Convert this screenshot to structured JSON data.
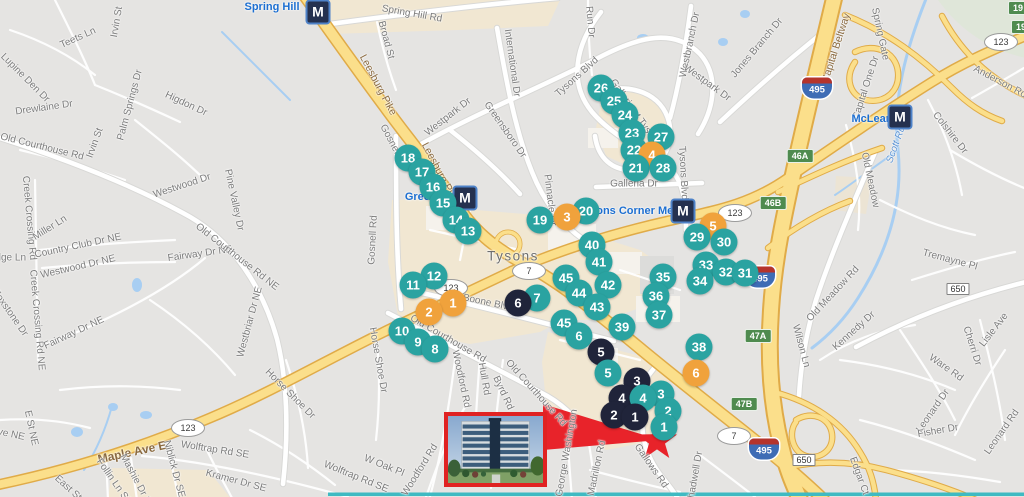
{
  "colors": {
    "teal": "#2aa3a1",
    "orange": "#f0a23c",
    "black": "#20243a",
    "red": "#e8232a",
    "metro_label": "#1d6fd1",
    "road_label": "#7b7b7b",
    "hwy_label": "#8a6a40",
    "water_label": "#5d94d4",
    "city_label": "#6e6e6e"
  },
  "map": {
    "metro_m": "M",
    "star": {
      "x": 657,
      "y": 441
    },
    "inset": {
      "x": 444,
      "y": 412,
      "w": 95,
      "h": 67
    },
    "metro_stations": [
      {
        "name": "Spring Hill",
        "mx": 318,
        "my": 12,
        "lx": 272,
        "ly": 7
      },
      {
        "name": "Greensboro",
        "mx": 465,
        "my": 198,
        "lx": 436,
        "ly": 197
      },
      {
        "name": "Tysons Corner Metro",
        "mx": 683,
        "my": 211,
        "lx": 633,
        "ly": 211
      },
      {
        "name": "McLean",
        "mx": 900,
        "my": 117,
        "lx": 872,
        "ly": 119
      }
    ],
    "shields": [
      {
        "type": "oval",
        "n": "123",
        "x": 188,
        "y": 428
      },
      {
        "type": "oval",
        "n": "123",
        "x": 451,
        "y": 288
      },
      {
        "type": "oval",
        "n": "123",
        "x": 735,
        "y": 213
      },
      {
        "type": "oval",
        "n": "123",
        "x": 1001,
        "y": 42
      },
      {
        "type": "oval",
        "n": "7",
        "x": 529,
        "y": 271
      },
      {
        "type": "oval",
        "n": "7",
        "x": 734,
        "y": 436
      },
      {
        "type": "i495",
        "n": "495",
        "x": 817,
        "y": 88
      },
      {
        "type": "i495",
        "n": "495",
        "x": 760,
        "y": 277
      },
      {
        "type": "i495",
        "n": "495",
        "x": 764,
        "y": 449
      },
      {
        "type": "green",
        "n": "46A",
        "x": 800,
        "y": 156
      },
      {
        "type": "green",
        "n": "46B",
        "x": 773,
        "y": 203
      },
      {
        "type": "green",
        "n": "47A",
        "x": 758,
        "y": 336
      },
      {
        "type": "green",
        "n": "47B",
        "x": 744,
        "y": 404
      },
      {
        "type": "green",
        "n": "19",
        "x": 1018,
        "y": 8
      },
      {
        "type": "green",
        "n": "19",
        "x": 1021,
        "y": 27
      },
      {
        "type": "rect",
        "n": "650",
        "x": 958,
        "y": 289
      },
      {
        "type": "rect",
        "n": "650",
        "x": 804,
        "y": 460
      }
    ],
    "markers": [
      {
        "n": "26",
        "c": "teal",
        "x": 601,
        "y": 88
      },
      {
        "n": "25",
        "c": "teal",
        "x": 614,
        "y": 101
      },
      {
        "n": "24",
        "c": "teal",
        "x": 625,
        "y": 115
      },
      {
        "n": "23",
        "c": "teal",
        "x": 632,
        "y": 133
      },
      {
        "n": "27",
        "c": "teal",
        "x": 661,
        "y": 137
      },
      {
        "n": "22",
        "c": "teal",
        "x": 634,
        "y": 150
      },
      {
        "n": "4",
        "c": "orange",
        "x": 652,
        "y": 155
      },
      {
        "n": "18",
        "c": "teal",
        "x": 408,
        "y": 158
      },
      {
        "n": "21",
        "c": "teal",
        "x": 636,
        "y": 168
      },
      {
        "n": "28",
        "c": "teal",
        "x": 663,
        "y": 168
      },
      {
        "n": "17",
        "c": "teal",
        "x": 422,
        "y": 172
      },
      {
        "n": "16",
        "c": "teal",
        "x": 433,
        "y": 187
      },
      {
        "n": "15",
        "c": "teal",
        "x": 443,
        "y": 203
      },
      {
        "n": "20",
        "c": "teal",
        "x": 586,
        "y": 211
      },
      {
        "n": "3",
        "c": "orange",
        "x": 567,
        "y": 217
      },
      {
        "n": "19",
        "c": "teal",
        "x": 540,
        "y": 220
      },
      {
        "n": "14",
        "c": "teal",
        "x": 456,
        "y": 220
      },
      {
        "n": "5",
        "c": "orange",
        "x": 713,
        "y": 226
      },
      {
        "n": "13",
        "c": "teal",
        "x": 468,
        "y": 231
      },
      {
        "n": "29",
        "c": "teal",
        "x": 697,
        "y": 237
      },
      {
        "n": "30",
        "c": "teal",
        "x": 724,
        "y": 242
      },
      {
        "n": "40",
        "c": "teal",
        "x": 592,
        "y": 245
      },
      {
        "n": "41",
        "c": "teal",
        "x": 599,
        "y": 262
      },
      {
        "n": "33",
        "c": "teal",
        "x": 706,
        "y": 265
      },
      {
        "n": "32",
        "c": "teal",
        "x": 726,
        "y": 272
      },
      {
        "n": "31",
        "c": "teal",
        "x": 745,
        "y": 273
      },
      {
        "n": "12",
        "c": "teal",
        "x": 434,
        "y": 276
      },
      {
        "n": "35",
        "c": "teal",
        "x": 663,
        "y": 277
      },
      {
        "n": "45",
        "c": "teal",
        "x": 566,
        "y": 278
      },
      {
        "n": "34",
        "c": "teal",
        "x": 700,
        "y": 281
      },
      {
        "n": "42",
        "c": "teal",
        "x": 608,
        "y": 285
      },
      {
        "n": "11",
        "c": "teal",
        "x": 413,
        "y": 285
      },
      {
        "n": "44",
        "c": "teal",
        "x": 579,
        "y": 293
      },
      {
        "n": "36",
        "c": "teal",
        "x": 656,
        "y": 296
      },
      {
        "n": "7",
        "c": "teal",
        "x": 537,
        "y": 298
      },
      {
        "n": "6",
        "c": "black",
        "x": 518,
        "y": 303
      },
      {
        "n": "1",
        "c": "orange",
        "x": 453,
        "y": 303
      },
      {
        "n": "43",
        "c": "teal",
        "x": 597,
        "y": 307
      },
      {
        "n": "2",
        "c": "orange",
        "x": 429,
        "y": 312
      },
      {
        "n": "37",
        "c": "teal",
        "x": 659,
        "y": 315
      },
      {
        "n": "45",
        "c": "teal",
        "x": 564,
        "y": 323
      },
      {
        "n": "39",
        "c": "teal",
        "x": 622,
        "y": 327
      },
      {
        "n": "10",
        "c": "teal",
        "x": 402,
        "y": 331
      },
      {
        "n": "6",
        "c": "teal",
        "x": 579,
        "y": 336
      },
      {
        "n": "9",
        "c": "teal",
        "x": 418,
        "y": 342
      },
      {
        "n": "38",
        "c": "teal",
        "x": 699,
        "y": 347
      },
      {
        "n": "8",
        "c": "teal",
        "x": 435,
        "y": 349
      },
      {
        "n": "5",
        "c": "black",
        "x": 601,
        "y": 352
      },
      {
        "n": "5",
        "c": "teal",
        "x": 608,
        "y": 373
      },
      {
        "n": "6",
        "c": "orange",
        "x": 696,
        "y": 373
      },
      {
        "n": "3",
        "c": "black",
        "x": 637,
        "y": 381
      },
      {
        "n": "3",
        "c": "teal",
        "x": 661,
        "y": 394
      },
      {
        "n": "4",
        "c": "black",
        "x": 622,
        "y": 398
      },
      {
        "n": "4",
        "c": "teal",
        "x": 643,
        "y": 398
      },
      {
        "n": "2",
        "c": "teal",
        "x": 668,
        "y": 411
      },
      {
        "n": "2",
        "c": "black",
        "x": 614,
        "y": 415
      },
      {
        "n": "1",
        "c": "black",
        "x": 635,
        "y": 417
      },
      {
        "n": "1",
        "c": "teal",
        "x": 664,
        "y": 427
      }
    ],
    "road_labels": [
      {
        "t": "Spring Hill Rd",
        "x": 412,
        "y": 14,
        "r": 10
      },
      {
        "t": "Broad St",
        "x": 386,
        "y": 40,
        "r": 75
      },
      {
        "t": "Leesburg Pike",
        "x": 378,
        "y": 85,
        "r": 62,
        "cls": "hwy"
      },
      {
        "t": "Leesburg Pike",
        "x": 440,
        "y": 173,
        "r": 62,
        "cls": "hwy"
      },
      {
        "t": "International Dr",
        "x": 512,
        "y": 63,
        "r": 82
      },
      {
        "t": "Westpark Dr",
        "x": 448,
        "y": 117,
        "r": -38
      },
      {
        "t": "Greensboro Dr",
        "x": 505,
        "y": 130,
        "r": 55
      },
      {
        "t": "Gosnell Rd",
        "x": 394,
        "y": 147,
        "r": 62
      },
      {
        "t": "Gosnell Rd",
        "x": 373,
        "y": 240,
        "r": -87
      },
      {
        "t": "Teets Ln",
        "x": 78,
        "y": 38,
        "r": -24
      },
      {
        "t": "Irvin St",
        "x": 117,
        "y": 22,
        "r": -80
      },
      {
        "t": "Irvin St",
        "x": 95,
        "y": 143,
        "r": -70
      },
      {
        "t": "Lupine Den Dr",
        "x": 25,
        "y": 78,
        "r": 45
      },
      {
        "t": "Drewlaine Dr",
        "x": 44,
        "y": 108,
        "r": -8
      },
      {
        "t": "Palm Springs Dr",
        "x": 130,
        "y": 105,
        "r": -75
      },
      {
        "t": "Higdon Dr",
        "x": 186,
        "y": 104,
        "r": 25
      },
      {
        "t": "Old Courthouse Rd",
        "x": 42,
        "y": 147,
        "r": 14
      },
      {
        "t": "Creek Crossing Rd",
        "x": 29,
        "y": 218,
        "r": 85
      },
      {
        "t": "Miller Ln",
        "x": 50,
        "y": 228,
        "r": -32
      },
      {
        "t": "Country Club Dr NE",
        "x": 78,
        "y": 246,
        "r": -12
      },
      {
        "t": "Westwood Dr NE",
        "x": 78,
        "y": 267,
        "r": -13
      },
      {
        "t": "Ridge Ln",
        "x": 6,
        "y": 258,
        "r": 0
      },
      {
        "t": "Creek Crossing Rd NE",
        "x": 37,
        "y": 320,
        "r": 85
      },
      {
        "t": "Foxstone Dr",
        "x": 10,
        "y": 313,
        "r": 55
      },
      {
        "t": "Fairway Dr NE",
        "x": 74,
        "y": 333,
        "r": -25
      },
      {
        "t": "Fairway Dr NE",
        "x": 200,
        "y": 254,
        "r": -8
      },
      {
        "t": "Old Courthouse Rd NE",
        "x": 237,
        "y": 257,
        "r": 38
      },
      {
        "t": "Pine Valley Dr",
        "x": 234,
        "y": 200,
        "r": 78
      },
      {
        "t": "Westbriar Dr NE",
        "x": 250,
        "y": 322,
        "r": -75
      },
      {
        "t": "Westwood Dr",
        "x": 182,
        "y": 186,
        "r": -18
      },
      {
        "t": "Maple Ave E",
        "x": 132,
        "y": 452,
        "r": -12,
        "cls": "hwy big"
      },
      {
        "t": "Wolftrap Rd SE",
        "x": 215,
        "y": 450,
        "r": 9
      },
      {
        "t": "Niblick Dr SE",
        "x": 174,
        "y": 469,
        "r": 75
      },
      {
        "t": "Follin Ln SE",
        "x": 114,
        "y": 482,
        "r": 55
      },
      {
        "t": "Mashie Dr SE",
        "x": 137,
        "y": 482,
        "r": 62
      },
      {
        "t": "Kramer Dr SE",
        "x": 236,
        "y": 481,
        "r": 15
      },
      {
        "t": "E St NE",
        "x": 31,
        "y": 428,
        "r": 78
      },
      {
        "t": "Ave NE",
        "x": 8,
        "y": 434,
        "r": 12
      },
      {
        "t": "East St",
        "x": 68,
        "y": 488,
        "r": 42
      },
      {
        "t": "Horse Shoe Dr",
        "x": 290,
        "y": 394,
        "r": 45
      },
      {
        "t": "Horse Shoe Dr",
        "x": 378,
        "y": 360,
        "r": 80
      },
      {
        "t": "Wolftrap Rd SE",
        "x": 356,
        "y": 477,
        "r": 22
      },
      {
        "t": "W Oak Pl",
        "x": 384,
        "y": 466,
        "r": 22
      },
      {
        "t": "Woodford Rd",
        "x": 420,
        "y": 470,
        "r": -58
      },
      {
        "t": "Woodford Rd",
        "x": 461,
        "y": 379,
        "r": 78
      },
      {
        "t": "Hull Rd",
        "x": 484,
        "y": 379,
        "r": 80
      },
      {
        "t": "Byrd Rd",
        "x": 503,
        "y": 393,
        "r": 65
      },
      {
        "t": "Old Courthouse Rd",
        "x": 448,
        "y": 339,
        "r": 30
      },
      {
        "t": "Old Courthouse Rd",
        "x": 536,
        "y": 393,
        "r": 48
      },
      {
        "t": "Boone Blvd",
        "x": 488,
        "y": 303,
        "r": 12
      },
      {
        "t": "Aline Ave",
        "x": 623,
        "y": 391,
        "r": -55
      },
      {
        "t": "Gallows Rd",
        "x": 651,
        "y": 466,
        "r": 55
      },
      {
        "t": "Madrillon Rd",
        "x": 597,
        "y": 468,
        "r": -78
      },
      {
        "t": "George Washington",
        "x": 567,
        "y": 453,
        "r": -80
      },
      {
        "t": "Shadwell Dr",
        "x": 695,
        "y": 478,
        "r": -80
      },
      {
        "t": "Pinnacle Dr",
        "x": 550,
        "y": 200,
        "r": 83
      },
      {
        "t": "Tysons Blvd",
        "x": 577,
        "y": 77,
        "r": -42
      },
      {
        "t": "Tysons Blvd",
        "x": 683,
        "y": 173,
        "r": 87
      },
      {
        "t": "Galleria at Tysons",
        "x": 635,
        "y": 113,
        "r": 55
      },
      {
        "t": "Galleria Dr",
        "x": 634,
        "y": 184,
        "r": 0
      },
      {
        "t": "Westbranch Dr",
        "x": 690,
        "y": 45,
        "r": -78
      },
      {
        "t": "Westpark Dr",
        "x": 707,
        "y": 83,
        "r": 36
      },
      {
        "t": "Jones Branch Dr",
        "x": 757,
        "y": 48,
        "r": -50
      },
      {
        "t": "Run Dr",
        "x": 590,
        "y": 22,
        "r": 85
      },
      {
        "t": "Capital Beltway",
        "x": 836,
        "y": 48,
        "r": -72,
        "cls": "hwy"
      },
      {
        "t": "Spring Gate",
        "x": 880,
        "y": 34,
        "r": 78
      },
      {
        "t": "Capital One Dr",
        "x": 866,
        "y": 88,
        "r": -72
      },
      {
        "t": "Anderson Rd",
        "x": 1000,
        "y": 82,
        "r": 28
      },
      {
        "t": "Colshire Dr",
        "x": 950,
        "y": 133,
        "r": 52
      },
      {
        "t": "Old Meadow",
        "x": 870,
        "y": 180,
        "r": 78
      },
      {
        "t": "Old Meadow Rd",
        "x": 833,
        "y": 294,
        "r": -47
      },
      {
        "t": "Tremayne Pl",
        "x": 950,
        "y": 260,
        "r": 15
      },
      {
        "t": "Kennedy Dr",
        "x": 854,
        "y": 331,
        "r": -42
      },
      {
        "t": "Wilson Ln",
        "x": 801,
        "y": 346,
        "r": 75
      },
      {
        "t": "Ware Rd",
        "x": 946,
        "y": 368,
        "r": 35
      },
      {
        "t": "Cherri Dr",
        "x": 972,
        "y": 346,
        "r": 72
      },
      {
        "t": "Lisle Ave",
        "x": 994,
        "y": 330,
        "r": -52
      },
      {
        "t": "Leonard Dr",
        "x": 933,
        "y": 411,
        "r": -55
      },
      {
        "t": "Fisher Dr",
        "x": 938,
        "y": 431,
        "r": -10
      },
      {
        "t": "Leonard Rd",
        "x": 1002,
        "y": 432,
        "r": -55
      },
      {
        "t": "Edgar Ct",
        "x": 859,
        "y": 476,
        "r": 70
      },
      {
        "t": "Scott Run",
        "x": 897,
        "y": 142,
        "r": -70,
        "cls": "water"
      },
      {
        "t": "Tysons",
        "x": 513,
        "y": 256,
        "r": 0,
        "cls": "city"
      }
    ]
  }
}
